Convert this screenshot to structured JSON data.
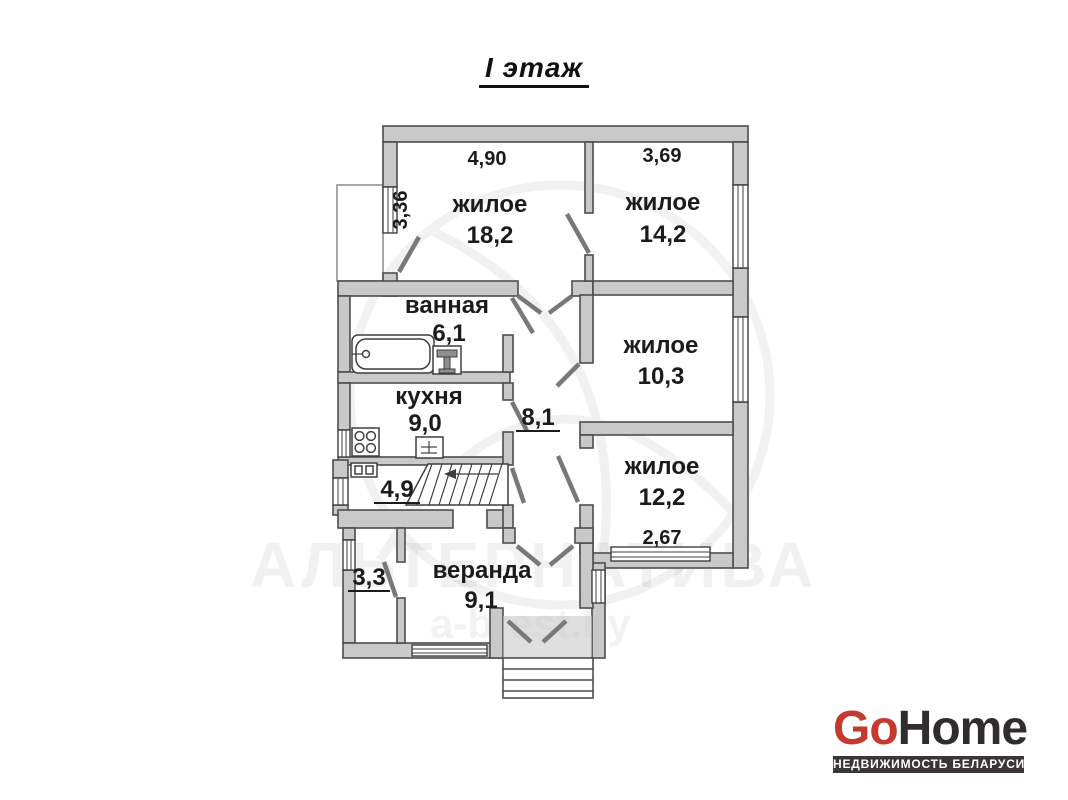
{
  "page": {
    "title": "I этаж"
  },
  "floor_plan": {
    "rooms": [
      {
        "name": "жилое",
        "area": "18,2",
        "dim_top": "4,90",
        "dim_side": "3,36"
      },
      {
        "name": "жилое",
        "area": "14,2",
        "dim_top": "3,69"
      },
      {
        "name": "ванная",
        "area": "6,1"
      },
      {
        "name": "кухня",
        "area": "9,0"
      },
      {
        "name": "жилое",
        "area": "10,3"
      },
      {
        "name": "жилое",
        "area": "12,2",
        "dim_bottom": "2,67"
      },
      {
        "name": "",
        "area": "8,1"
      },
      {
        "name": "",
        "area": "4,9"
      },
      {
        "name": "",
        "area": "3,3"
      },
      {
        "name": "веранда",
        "area": "9,1"
      }
    ],
    "fixtures": [
      "bathtub-icon",
      "toilet-icon",
      "stove-icon",
      "sink-icon",
      "stairs-icon",
      "entrance-steps"
    ],
    "colors": {
      "wall_fill": "#c9c9c9",
      "wall_outline": "#4d4d4d",
      "label_text": "#1b1b1b"
    }
  },
  "watermark": {
    "line1": "АЛЬТЕРНАТИВА",
    "line2": "a-brest.by"
  },
  "logo": {
    "go": "Go",
    "home": "Home",
    "tagline": "НЕДВИЖИМОСТЬ БЕЛАРУСИ",
    "go_color": "#c23b2e",
    "home_color": "#312d2e",
    "bar_color": "#3a3536"
  }
}
